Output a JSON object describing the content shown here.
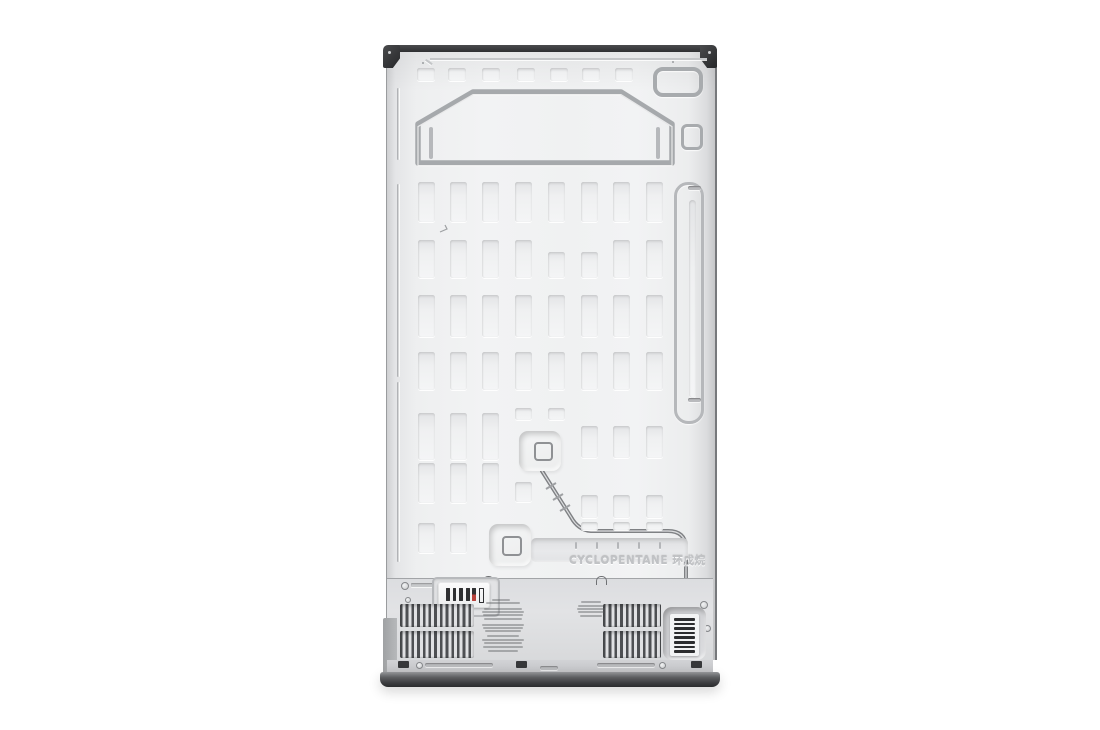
{
  "panel": {
    "embossed_text": "CYCLOPENTANE 环戊烷"
  },
  "colors": {
    "background": "#ffffff",
    "panel": "#f0f1f2",
    "panel_edge": "#c9cbcd",
    "groove": "#a8abae",
    "trim_dark": "#2f3032",
    "base_dark": "#37383b",
    "vent_slat": "#4e5053",
    "label_bar": "#2f3032",
    "label_accent_red": "#b8413a",
    "tube": "#7f8184"
  }
}
